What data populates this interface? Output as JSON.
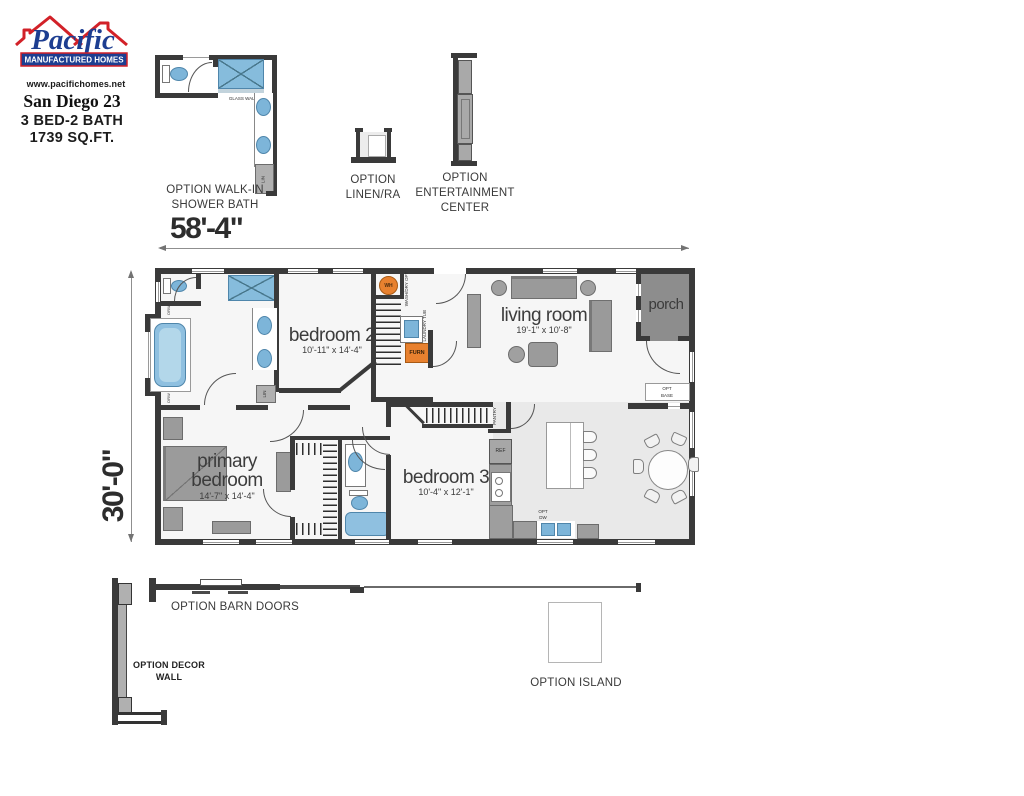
{
  "brand": {
    "name": "Pacific",
    "subtitle": "MANUFACTURED HOMES",
    "website": "www.pacifichomes.net"
  },
  "plan_info": {
    "model": "San Diego 23",
    "config": "3 BED-2 BATH",
    "area": "1739 SQ.FT."
  },
  "dimensions": {
    "overall_width": "58'-4\"",
    "overall_depth": "30'-0\""
  },
  "rooms": {
    "bedroom2": {
      "name": "bedroom 2",
      "dims": "10'-11\" x 14'-4\""
    },
    "living_room": {
      "name": "living room",
      "dims": "19'-1\" x 10'-8\""
    },
    "porch": {
      "name": "porch"
    },
    "primary_bedroom": {
      "name": "primary bedroom",
      "dims": "14'-7\" x 14'-4\""
    },
    "bedroom3": {
      "name": "bedroom 3",
      "dims": "10'-4\" x 12'-1\""
    }
  },
  "options": {
    "walk_in_shower_bath": "OPTION WALK-IN SHOWER BATH",
    "linen": "OPTION LINEN/RA",
    "entertainment_center": "OPTION ENTERTAINMENT CENTER",
    "barn_doors": "OPTION BARN DOORS",
    "decor_wall": "OPTION DECOR WALL",
    "island": "OPTION ISLAND"
  },
  "fixtures": {
    "glass_wall": "GLASS WALL",
    "lin": "LIN",
    "wh": "WH",
    "wash_dry": "WASH/DRY OPT",
    "laundry_tub": "OPT LAUNDRY TUB",
    "furnace": "FURN",
    "opt_base": "OPT BASE",
    "pantry": "PANTRY",
    "ref": "REF",
    "opt_dw": "OPT DW",
    "drw": "DRW"
  },
  "colors": {
    "wall": "#3a3a3a",
    "fixture_blue": "#7db5d9",
    "shower_blue": "#86bcdc",
    "accent_orange": "#e8812f",
    "furniture_gray": "#9b9b9b",
    "porch_gray": "#8d8d8d",
    "logo_blue": "#1d3e91",
    "logo_red": "#d22128"
  }
}
